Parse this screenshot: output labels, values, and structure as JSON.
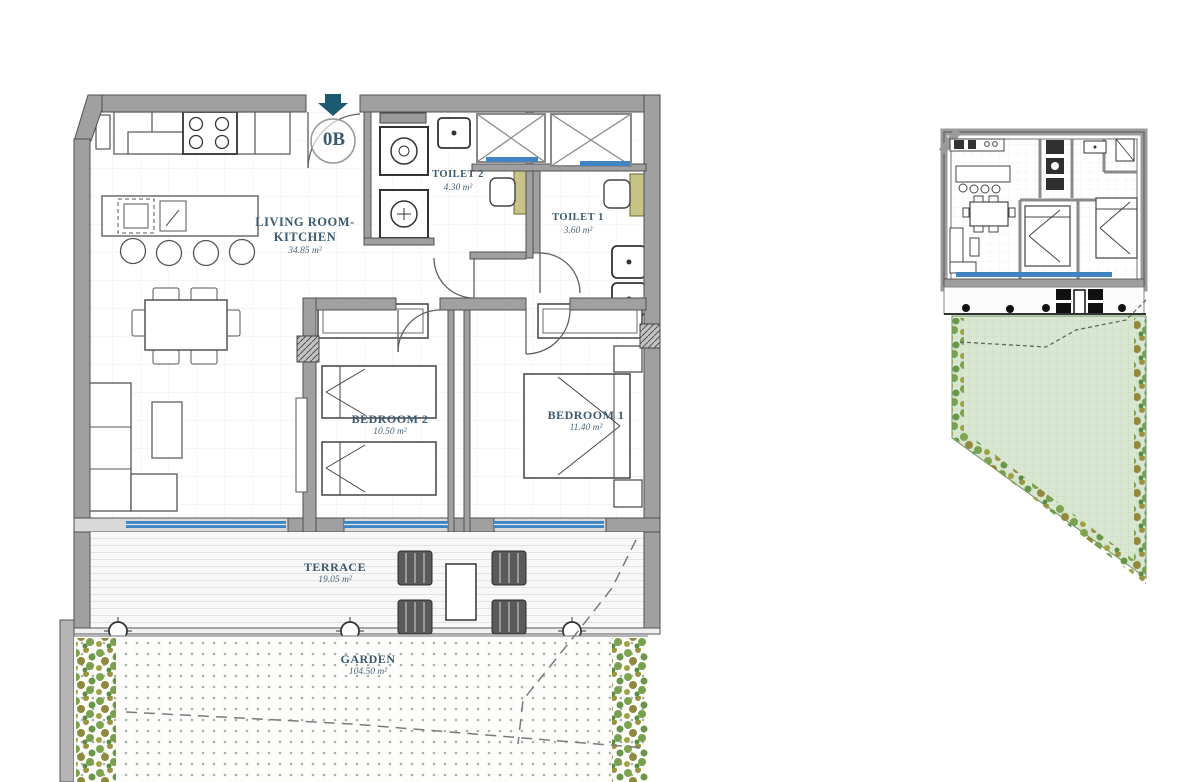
{
  "unit": {
    "label": "0B"
  },
  "rooms": {
    "living": {
      "name": "LIVING ROOM-KITCHEN",
      "area": "34.85 m²"
    },
    "toilet2": {
      "name": "TOILET 2",
      "area": "4.30 m²"
    },
    "toilet1": {
      "name": "TOILET 1",
      "area": "3.60 m²"
    },
    "bedroom2": {
      "name": "BEDROOM 2",
      "area": "10.50 m²"
    },
    "bedroom1": {
      "name": "BEDROOM 1",
      "area": "11.40 m²"
    },
    "terrace": {
      "name": "TERRACE",
      "area": "19.05 m²"
    },
    "garden": {
      "name": "GARDEN",
      "area": "104.50 m²"
    }
  },
  "colors": {
    "wall": "#a0a0a0",
    "wall_edge": "#4f4f4f",
    "window_blue": "#3f85c4",
    "label_blue": "#3b5a6f",
    "entry_arrow_teal": "#1b5a70",
    "garden_green": "#d9e7d2",
    "flower_olive": "#8f8a3e",
    "flower_green": "#6a9747"
  }
}
